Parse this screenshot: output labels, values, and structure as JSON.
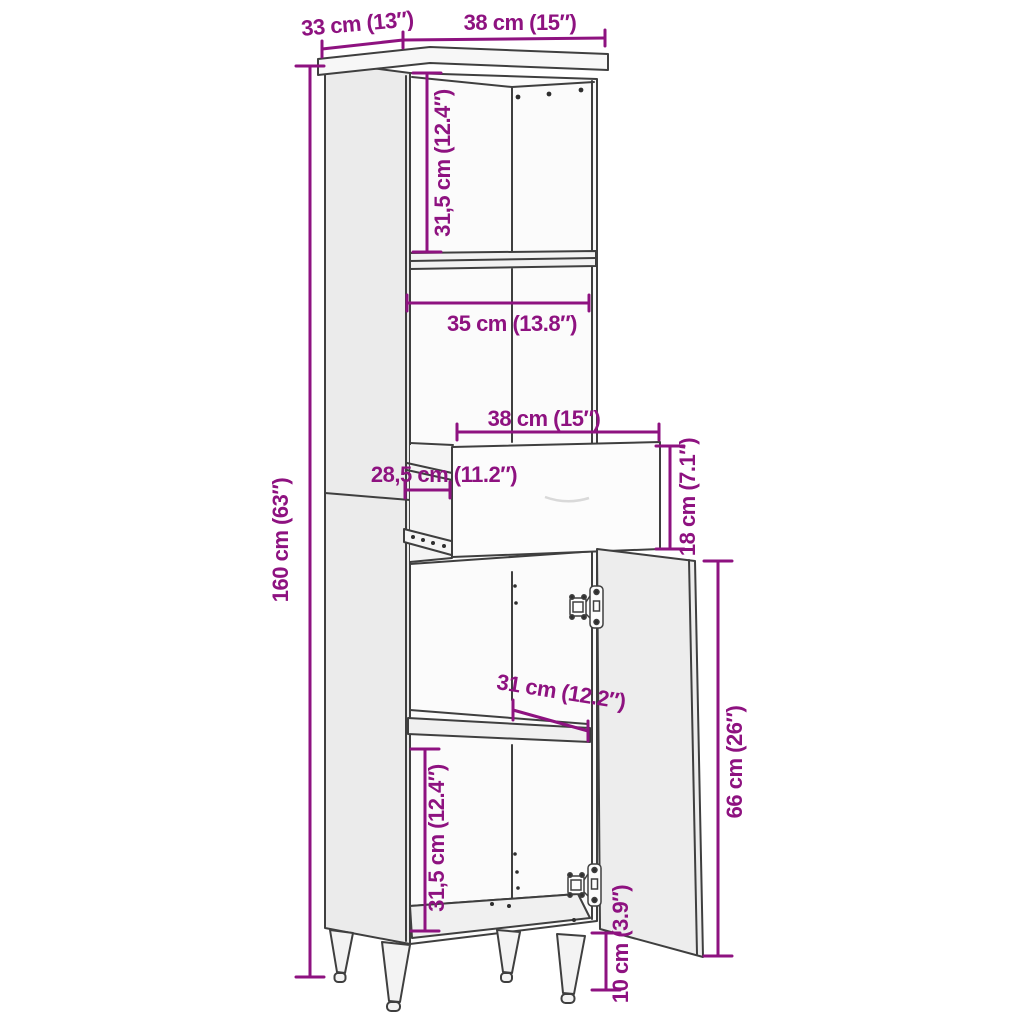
{
  "diagram": {
    "subject": "tall-cabinet-with-drawer-and-door",
    "background": "#ffffff"
  },
  "palette": {
    "dimension_color": "#8E1280",
    "outline_color": "#3F3F3F",
    "side_panel_fill": "#EBEBEB",
    "front_fill": "#FBFBFB",
    "door_fill": "#EDEDED"
  },
  "dimensions": {
    "top_depth": "33 cm (13″)",
    "top_width": "38 cm (15″)",
    "overall_height": "160 cm (63″)",
    "upper_compartment_height": "31,5 cm (12.4″)",
    "middle_compartment_width": "35 cm (13.8″)",
    "drawer_width": "38 cm (15″)",
    "drawer_depth": "28,5 cm (11.2″)",
    "drawer_height": "18 cm (7.1″)",
    "lower_shelf_width": "31 cm (12.2″)",
    "door_height": "66 cm (26″)",
    "lower_compartment_height": "31,5 cm (12.4″)",
    "leg_height": "10 cm (3.9″)"
  }
}
